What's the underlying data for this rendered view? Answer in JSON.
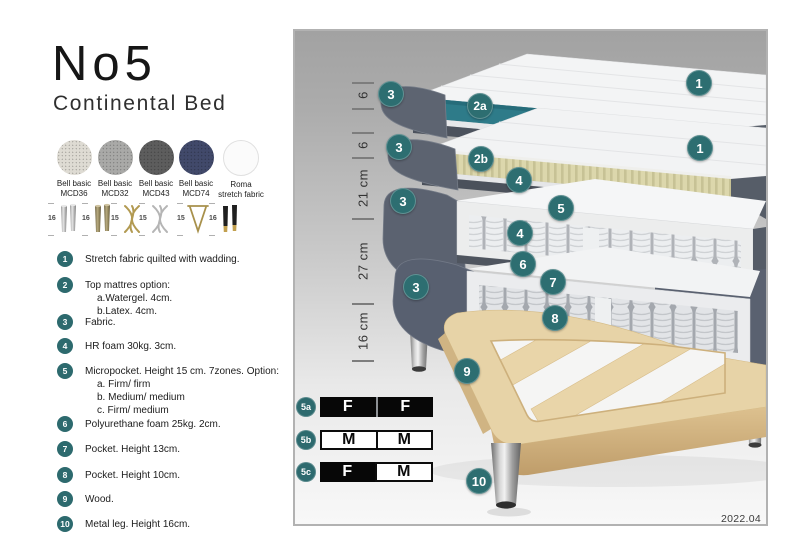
{
  "header": {
    "title": "No5",
    "subtitle": "Continental Bed"
  },
  "fabric_swatches": [
    {
      "name": "Bell basic",
      "code": "MCD36"
    },
    {
      "name": "Bell basic",
      "code": "MCD32"
    },
    {
      "name": "Bell basic",
      "code": "MCD43"
    },
    {
      "name": "Bell basic",
      "code": "MCD74"
    },
    {
      "name": "Roma",
      "code": "stretch fabric"
    }
  ],
  "leg_options": [
    {
      "height": "16",
      "style": "cylinder-silver"
    },
    {
      "height": "16",
      "style": "cylinder-brass"
    },
    {
      "height": "15",
      "style": "twisted-gold"
    },
    {
      "height": "15",
      "style": "twisted-silver"
    },
    {
      "height": "15",
      "style": "hairpin-gold"
    },
    {
      "height": "16",
      "style": "cylinder-black-gold"
    }
  ],
  "features": [
    {
      "num": "1",
      "text": "Stretch fabric quilted with wadding."
    },
    {
      "num": "2",
      "text": "Top mattres option:",
      "subs": [
        "a.Watergel. 4cm.",
        "b.Latex. 4cm."
      ]
    },
    {
      "num": "3",
      "text": "Fabric."
    },
    {
      "num": "4",
      "text": "HR foam 30kg. 3cm."
    },
    {
      "num": "5",
      "text": "Micropocket. Height 15 cm. 7zones. Option:",
      "subs": [
        "a. Firm/ firm",
        "b. Medium/ medium",
        "c. Firm/ medium"
      ]
    },
    {
      "num": "6",
      "text": "Polyurethane foam 25kg. 2cm."
    },
    {
      "num": "7",
      "text": "Pocket. Height 13cm."
    },
    {
      "num": "8",
      "text": "Pocket. Height 10cm."
    },
    {
      "num": "9",
      "text": "Wood."
    },
    {
      "num": "10",
      "text": "Metal leg. Height 16cm."
    }
  ],
  "diagram": {
    "dimensions": [
      "6",
      "6",
      "21 cm",
      "27 cm",
      "16 cm"
    ],
    "callouts": {
      "stretch_top": "1",
      "stretch_mid": "1",
      "topper_watergel": "2a",
      "topper_latex": "2b",
      "fabric_a": "3",
      "fabric_b": "3",
      "fabric_c": "3",
      "fabric_d": "3",
      "hr_foam_top": "4",
      "hr_foam_bottom": "4",
      "micropocket": "5",
      "pu_foam": "6",
      "pocket_13": "7",
      "pocket_10": "8",
      "wood": "9",
      "metal_leg": "10"
    },
    "version": "2022.04"
  },
  "firmness": {
    "rows": [
      {
        "label": "5a",
        "cells": [
          {
            "text": "F",
            "variant": "dark"
          },
          {
            "text": "F",
            "variant": "dark"
          }
        ]
      },
      {
        "label": "5b",
        "cells": [
          {
            "text": "M",
            "variant": "light"
          },
          {
            "text": "M",
            "variant": "light"
          }
        ]
      },
      {
        "label": "5c",
        "cells": [
          {
            "text": "F",
            "variant": "dark"
          },
          {
            "text": "M",
            "variant": "light"
          }
        ]
      }
    ]
  },
  "colors": {
    "accent_teal": "#2d6e71",
    "core_teal": "#2e7b89",
    "fabric_gray": "#5c6370",
    "latex_beige": "#dcd7ac",
    "wood": "#e7d3a7"
  }
}
